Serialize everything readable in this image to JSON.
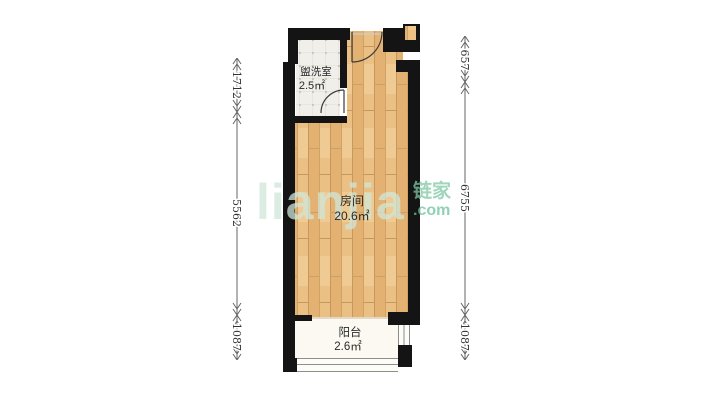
{
  "watermark": {
    "logo": "lianjia",
    "brand": "链家",
    "domain": ".com",
    "logo_color": "#cfe6d9",
    "brand_color": "#7fc8a4",
    "domain_color": "#6cc19b"
  },
  "plan": {
    "rooms": [
      {
        "id": "washroom",
        "label": "盥洗室",
        "area": "2.5㎡"
      },
      {
        "id": "main-room",
        "label": "房间",
        "area": "20.6㎡"
      },
      {
        "id": "balcony",
        "label": "阳台",
        "area": "2.6㎡"
      }
    ],
    "dimensions": {
      "left": [
        "1712",
        "5562",
        "1087"
      ],
      "right": [
        "657",
        "6755",
        "1087"
      ]
    }
  },
  "colors": {
    "wall": "#141414",
    "wood_floor": "#eac084",
    "tile_floor": "#f1efe9",
    "balcony_floor": "#fbf9f1",
    "dimension": "#555555"
  }
}
